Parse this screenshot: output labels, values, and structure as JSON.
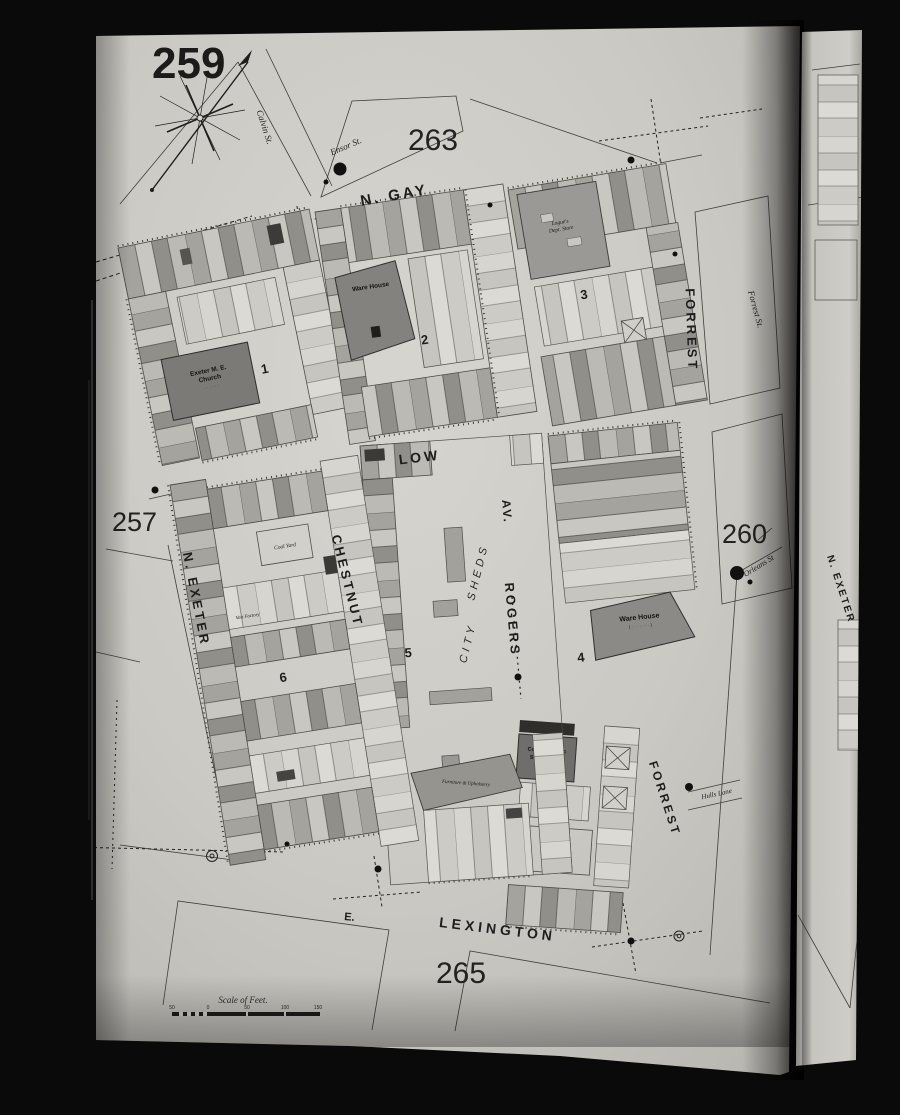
{
  "sheet": {
    "number": "259",
    "volume_note": "Balto. Vol. 2",
    "adjacent_top": "263",
    "adjacent_left": "257",
    "adjacent_right": "260",
    "adjacent_bottom": "265"
  },
  "streets": {
    "n_gay": "N. GAY",
    "low": "LOW",
    "lexington_prefix": "E.",
    "lexington": "LEXINGTON",
    "n_exeter": "N. EXETER",
    "chestnut": "CHESTNUT",
    "rogers": "ROGERS",
    "rogers_av": "AV.",
    "forrest_upper": "FORREST",
    "forrest_lower": "FORREST",
    "forrest_st": "Forrest St.",
    "calvin_st": "Calvin St.",
    "ensor_st": "Ensor St.",
    "orleans_st": "Orleans St",
    "hulls_lane": "Hulls Lane",
    "next_page_exeter": "N. EXETER"
  },
  "blocks": {
    "b1": "1",
    "b2": "2",
    "b3": "3",
    "b4": "4",
    "b5": "5",
    "b6": "6"
  },
  "labels": {
    "warehouse2": "Ware House",
    "logues1": "Logue's",
    "logues2": "Dept. Store",
    "church1": "Exeter M. E.",
    "church2": "Church",
    "church3": "· · · · · ·",
    "city": "CITY",
    "sheds": "SHEDS",
    "warehouse4": "Ware House",
    "warehouse4_sub": "( · · · · · · · )",
    "furniture": "Furniture & Upholstery",
    "school1": "Colored Public",
    "school2": "School No. 2",
    "school3": "· · · · ·",
    "coal_yard4": "Coal Yard",
    "coal_yard6": "Coal Yard",
    "vest_factory": "Vest Factory"
  },
  "scale": {
    "title": "Scale of Feet.",
    "t1": "50",
    "t2": "0",
    "t3": "50",
    "t4": "100",
    "t5": "150"
  }
}
